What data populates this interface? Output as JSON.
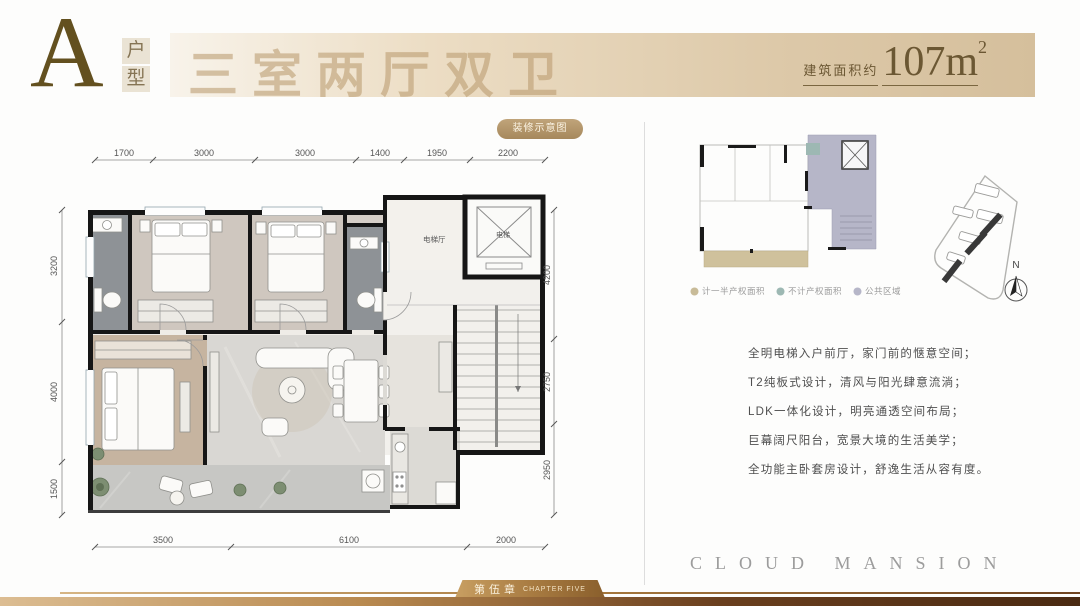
{
  "header": {
    "unit_letter": "A",
    "unit_type_vertical": [
      "户",
      "型"
    ],
    "title": "三室两厅双卫",
    "area_label": "建筑面积约",
    "area_value": "107m",
    "area_exponent": "2"
  },
  "plan": {
    "badge": "装修示意图",
    "room_labels": {
      "elevator_hall": "电梯厅",
      "elevator": "电梯"
    },
    "dims_top": [
      "1700",
      "3000",
      "3000",
      "1400",
      "1950",
      "2200"
    ],
    "dims_left": [
      "3200",
      "4000",
      "1500"
    ],
    "dims_right": [
      "4200",
      "2750",
      "2950"
    ],
    "dims_bottom": [
      "3500",
      "6100",
      "2000"
    ]
  },
  "keyplan": {
    "legend": [
      {
        "label": "计一半产权面积",
        "color": "#c8bb98"
      },
      {
        "label": "不计产权面积",
        "color": "#9db8b3"
      },
      {
        "label": "公共区域",
        "color": "#b6b6c8"
      }
    ],
    "compass_label": "N"
  },
  "features": [
    "全明电梯入户前厅，家门前的惬意空间；",
    "T2纯板式设计，清风与阳光肆意流淌；",
    "LDK一体化设计，明亮通透空间布局；",
    "巨幕阔尺阳台，宽景大境的生活美学；",
    "全功能主卧套房设计，舒逸生活从容有度。"
  ],
  "footer": {
    "brand": "CLOUD MANSION",
    "chapter_cn": "第伍章",
    "chapter_en": "CHAPTER FIVE"
  }
}
